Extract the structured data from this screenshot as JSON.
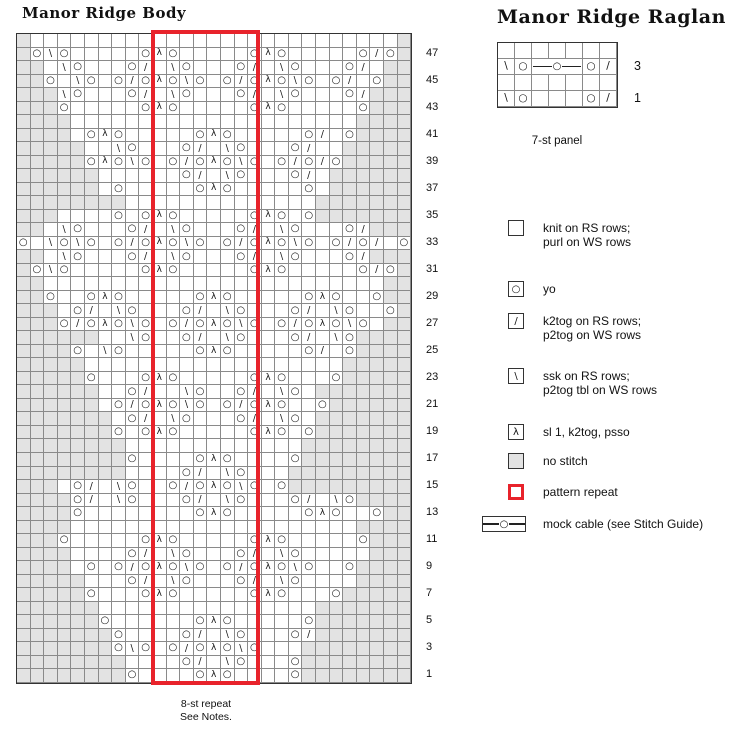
{
  "body_chart": {
    "title": "Manor Ridge Body",
    "row_numbers": [
      47,
      45,
      43,
      41,
      39,
      37,
      35,
      33,
      31,
      29,
      27,
      25,
      23,
      21,
      19,
      17,
      15,
      13,
      11,
      9,
      7,
      5,
      3,
      1
    ],
    "rows": [
      "G...........................G",
      "GOsO.....OLO.....OLO.....OkOG",
      "GG.sO...Ok.sO...Ok.sO...Ok.GG",
      "GGO.sO.OkOLOsO.OkOLOsO.Ok.OGG",
      "GGGsO...Ok.sO...Ok.sO...OkGGG",
      "GGGO.....OLO.....OLO.....OGGG",
      "GGGG.....................GGGG",
      "GGGG.OLO.....OLO.....Ok.OGGGG",
      "GGGGG..sO...Ok.sO...Ok..GGGGG",
      "GGGGGOLOsO.OkOLOsO.OkOkOGGGGG",
      "GGGGGG......Ok.sO...Ok.GGGGGG",
      "GGGGGG.O.....OLO.....O.GGGGGG",
      "GGGGGGGG..............GGGGGGG",
      "GGG....O.OLO.....OLO.OGGGGGGG",
      "GG.sO...Ok.sO...Ok.sO...OkGGG",
      "O.sOsO.OkOLOsO.OkOLOsO.OkOk.O",
      "GG.sO...Ok.sO...Ok.sO...OkGGG",
      "GOsO.....OLO.....OLO.....OkOG",
      "GG.........................GG",
      "GGO..OLO.....OLO.....OLO..OGG",
      "GGG.Ok.sO...Ok.sO...Ok.sO..OG",
      "GGGOkOLOsO.OkOLOsO.OkOLOsO.GG",
      "GGGGGG..sO..Ok.sO...Ok.sOGGGG",
      "GGGGO.sO.....OLO.....Ok.OGGGG",
      "GGGGG...................GGGGG",
      "GGGGGO...OLO.....OLO...OGGGGG",
      "GGGGGG..Ok..sO..Ok.sO.GGGGGGG",
      "GGGGGG.OkOLOsO.OkOLO..OGGGGGG",
      "GGGGGGG.Ok.sO...Ok.sO.GGGGGGG",
      "GGGGGGGO.OLO.....OLO.OGGGGGGG",
      "GGGGGGGG.............GGGGGGGG",
      "GGGGGGGGO....OLO....OGGGGGGGG",
      "GGGGGGGG....Ok.sO...GGGGGGGGG",
      "GGG.Ok.sO..OkOLOsO.OGGGGGGGGG",
      "GGGGOk.sO...Ok.sO...Ok.sOGGGG",
      "GGGGO........OLO.....OLO..OGG",
      "GGGG.....................GGGG",
      "GGGO.....OLO.....OLO.....OGGG",
      "GGGG....Ok.sO...Ok.sO.....GGG",
      "GGGG.O.OkOLOsO.OkOLOsO..OGGGG",
      "GGGGG...Ok.sO...Ok.sO....GGGG",
      "GGGGGO...OLO.....OLO...OGGGGG",
      "GGGGGG................GGGGGGG",
      "GGGGGGO......OLO.....OGGGGGGG",
      "GGGGGGGO....Ok.sO...OkGGGGGGG",
      "GGGGGGGOsO.OkOLOsO...GGGGGGGG",
      "GGGGGGGG....Ok.sO...OGGGGGGGG",
      "GGGGGGGGO....OLO....OGGGGGGGG"
    ],
    "repeat": {
      "start_col": 10,
      "span": 8,
      "caption_line1": "8-st repeat",
      "caption_line2": "See Notes."
    }
  },
  "raglan_chart": {
    "title": "Manor Ridge Raglan",
    "rows": [
      ".......",
      "sOCCCOk",
      ".......",
      "sO...Ok"
    ],
    "row_labels": [
      {
        "text": "3",
        "row_index": 1
      },
      {
        "text": "1",
        "row_index": 3
      }
    ],
    "caption": "7-st panel"
  },
  "legend": {
    "items": [
      {
        "key": "knit",
        "swatch": "blank",
        "label": "knit on RS rows;\npurl on WS rows",
        "y": 220
      },
      {
        "key": "yo",
        "swatch": "O",
        "label": "yo",
        "y": 281
      },
      {
        "key": "k2tog",
        "swatch": "k",
        "label": "k2tog on RS rows;\np2tog on WS rows",
        "y": 313
      },
      {
        "key": "ssk",
        "swatch": "s",
        "label": "ssk on RS rows;\np2tog tbl on WS rows",
        "y": 368
      },
      {
        "key": "sl1-k2tog-psso",
        "swatch": "L",
        "label": "sl 1, k2tog, psso",
        "y": 424
      },
      {
        "key": "no-stitch",
        "swatch": "gray",
        "label": "no stitch",
        "y": 453
      },
      {
        "key": "pattern-repeat",
        "swatch": "red",
        "label": "pattern repeat",
        "y": 484
      },
      {
        "key": "mock-cable",
        "swatch": "cable",
        "label": "mock cable (see Stitch Guide)",
        "y": 516
      }
    ]
  },
  "colors": {
    "repeat_red": "#e8232b",
    "no_stitch_gray": "#e3e3e3",
    "grid_line": "#8a8a8a",
    "symbol": "#151515"
  },
  "symbols": {
    "O": "yo",
    "k": "k2tog",
    "s": "ssk",
    "L": "sl1-k2tog-psso",
    "G": "no-stitch",
    "C": "mock-cable"
  }
}
